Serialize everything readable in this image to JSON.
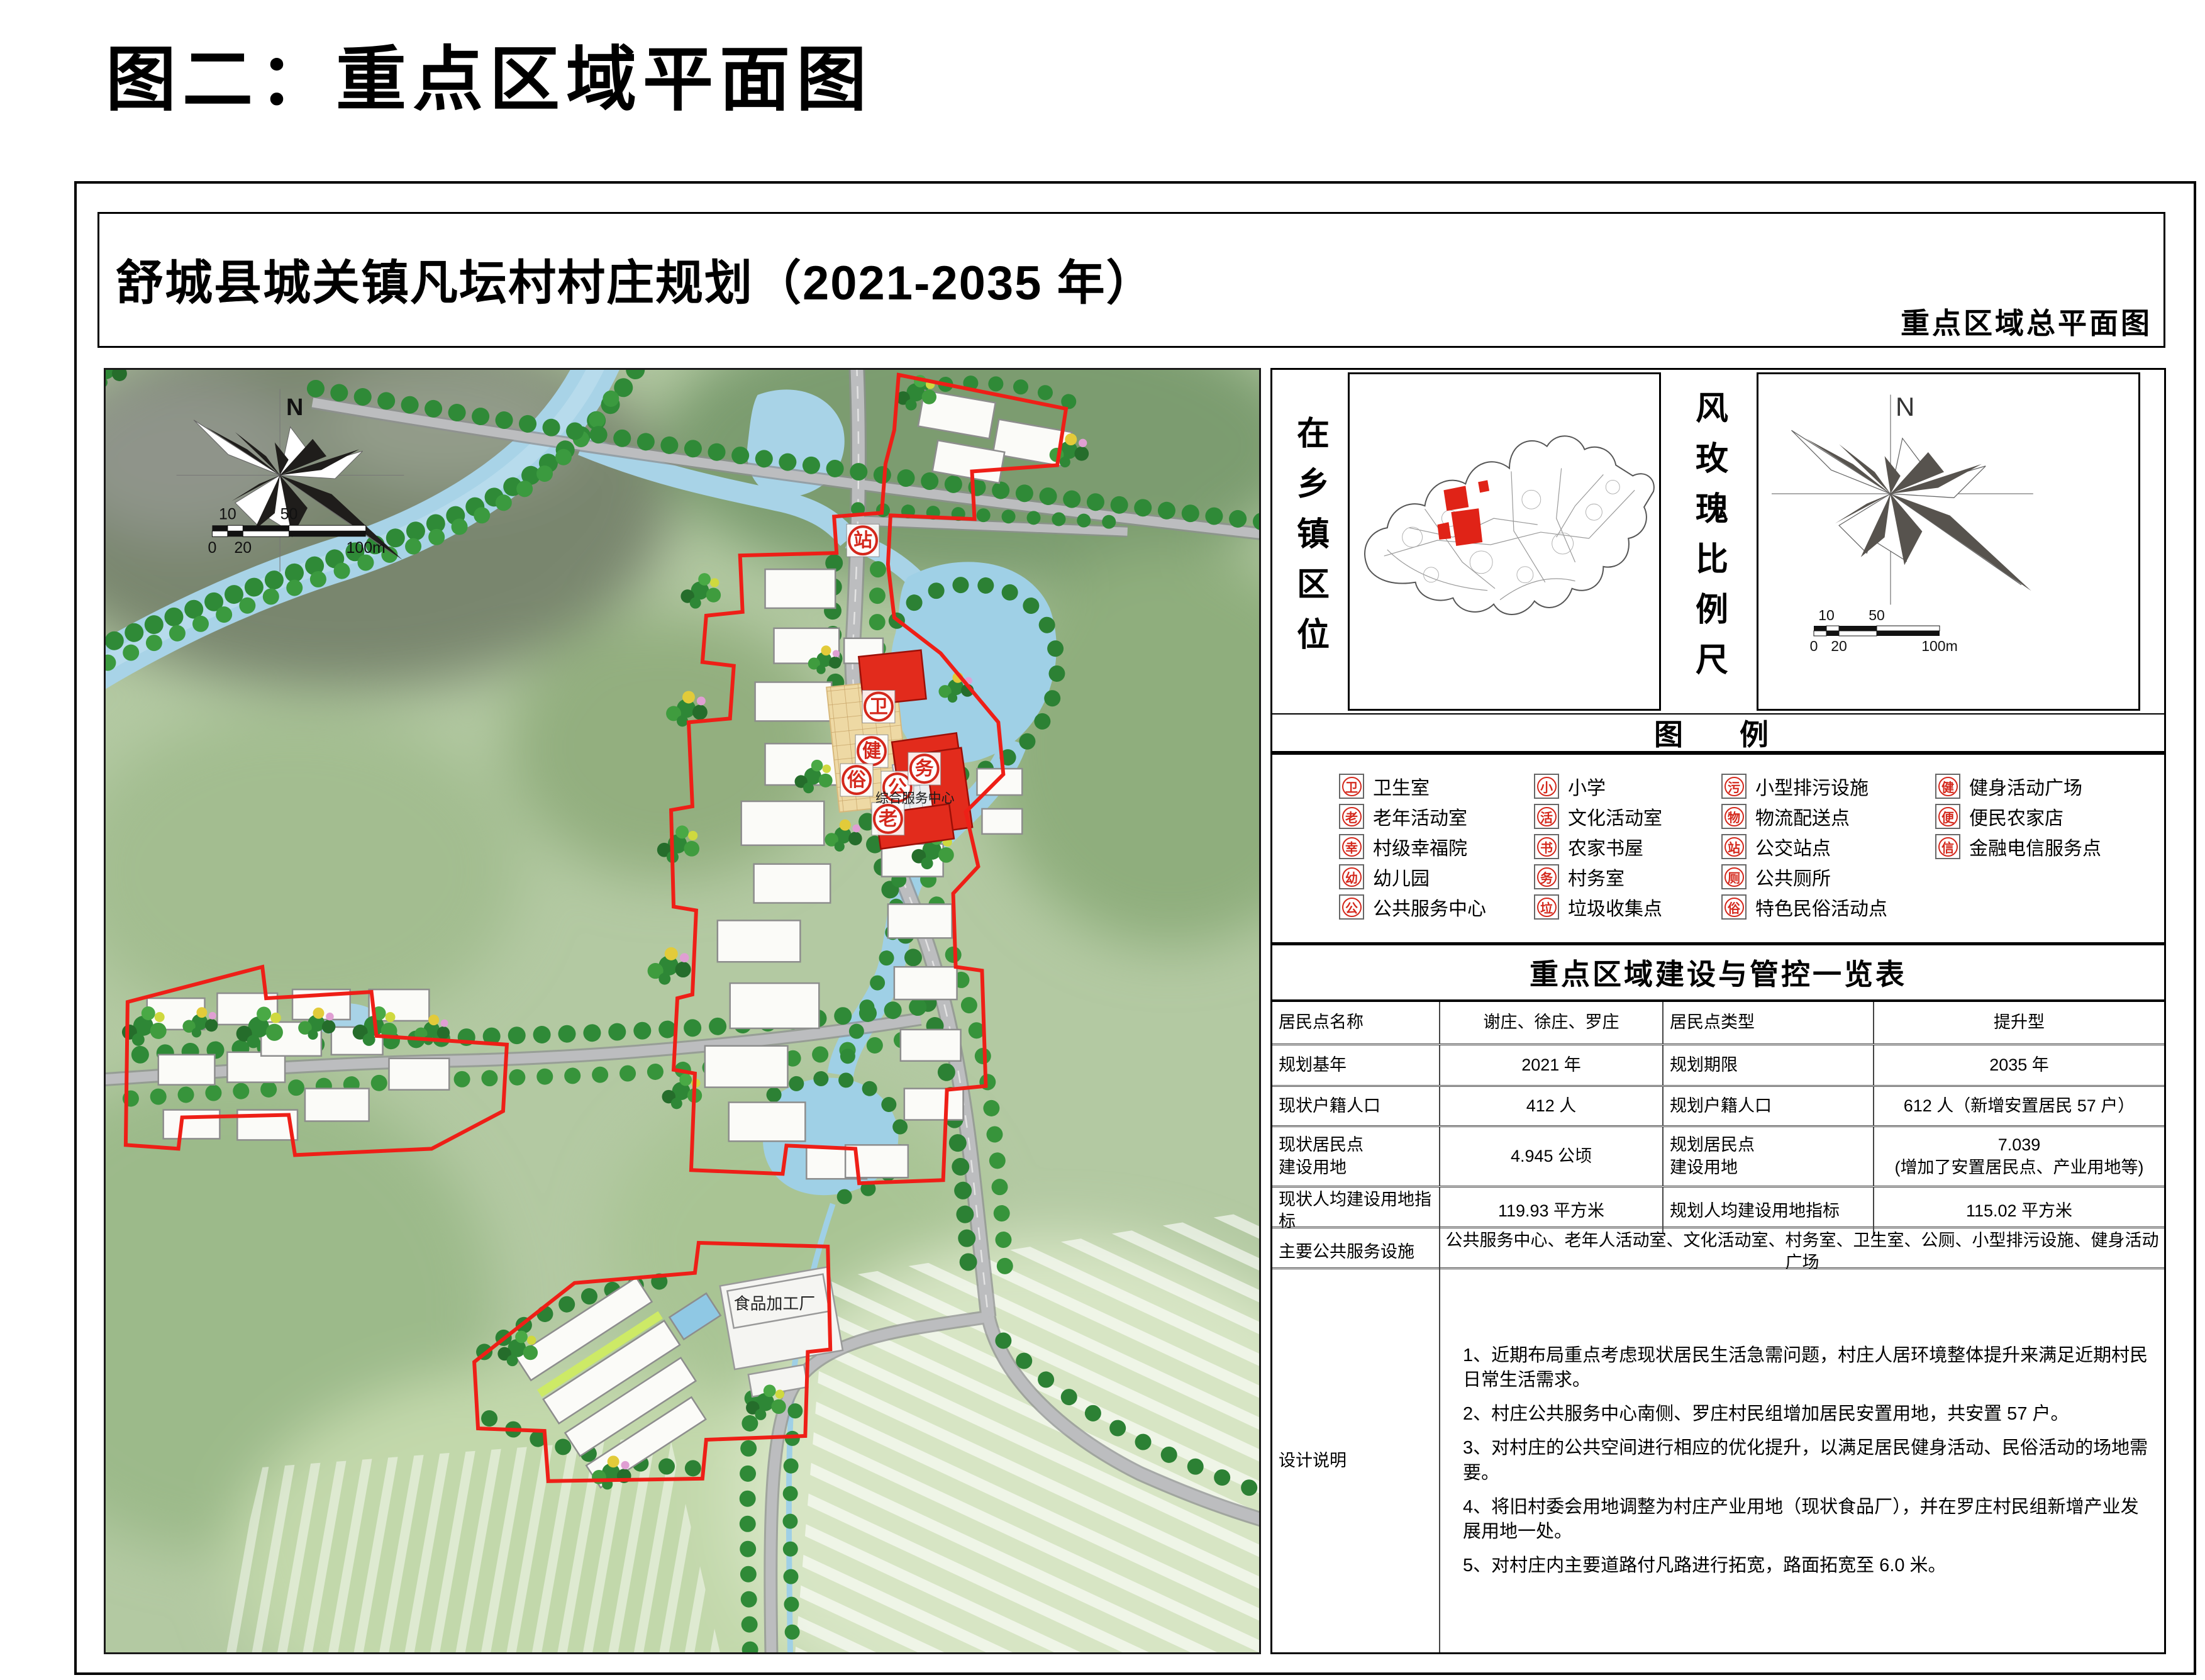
{
  "page": {
    "title": "图二：重点区域平面图"
  },
  "sheet": {
    "title": "舒城县城关镇凡坛村村庄规划（2021-2035 年）",
    "subtitle": "重点区域总平面图"
  },
  "compass": {
    "north": "N"
  },
  "scalebar": {
    "ten": "10",
    "fifty": "50",
    "zero": "0",
    "twenty": "20",
    "hundred": "100m"
  },
  "map": {
    "labels": {
      "service_center": "综合服务中心",
      "food_factory": "食品加工厂"
    },
    "poi": {
      "wei": "卫",
      "jian": "健",
      "su": "俗",
      "gong": "公",
      "wu": "务",
      "lao": "老",
      "zhan": "站"
    }
  },
  "panel": {
    "location_label": "在乡镇区位",
    "windrose_label": "风玫瑰比例尺",
    "legend": {
      "title": "图　例",
      "columns": [
        {
          "items": [
            {
              "abbr": "卫",
              "label": "卫生室"
            },
            {
              "abbr": "老",
              "label": "老年活动室"
            },
            {
              "abbr": "幸",
              "label": "村级幸福院"
            },
            {
              "abbr": "幼",
              "label": "幼儿园"
            },
            {
              "abbr": "公",
              "label": "公共服务中心"
            }
          ]
        },
        {
          "items": [
            {
              "abbr": "小",
              "label": "小学"
            },
            {
              "abbr": "活",
              "label": "文化活动室"
            },
            {
              "abbr": "书",
              "label": "农家书屋"
            },
            {
              "abbr": "务",
              "label": "村务室"
            },
            {
              "abbr": "垃",
              "label": "垃圾收集点"
            }
          ]
        },
        {
          "items": [
            {
              "abbr": "污",
              "label": "小型排污设施"
            },
            {
              "abbr": "物",
              "label": "物流配送点"
            },
            {
              "abbr": "站",
              "label": "公交站点"
            },
            {
              "abbr": "厕",
              "label": "公共厕所"
            },
            {
              "abbr": "俗",
              "label": "特色民俗活动点"
            }
          ]
        },
        {
          "items": [
            {
              "abbr": "健",
              "label": "健身活动广场"
            },
            {
              "abbr": "便",
              "label": "便民农家店"
            },
            {
              "abbr": "信",
              "label": "金融电信服务点"
            }
          ]
        }
      ]
    },
    "table": {
      "title": "重点区域建设与管控一览表",
      "rows": [
        [
          "居民点名称",
          "谢庄、徐庄、罗庄",
          "居民点类型",
          "提升型"
        ],
        [
          "规划基年",
          "2021 年",
          "规划期限",
          "2035 年"
        ],
        [
          "现状户籍人口",
          "412 人",
          "规划户籍人口",
          "612 人（新增安置居民 57 户）"
        ],
        [
          "现状居民点\n建设用地",
          "4.945 公顷",
          "规划居民点\n建设用地",
          "7.039\n(增加了安置居民点、产业用地等)"
        ],
        [
          "现状人均建设用地指标",
          "119.93 平方米",
          "规划人均建设用地指标",
          "115.02 平方米"
        ],
        [
          "主要公共服务设施",
          "公共服务中心、老年人活动室、文化活动室、村务室、卫生室、公厕、小型排污设施、健身活动广场"
        ]
      ]
    },
    "notes": {
      "label": "设计说明",
      "items": [
        "1、近期布局重点考虑现状居民生活急需问题，村庄人居环境整体提升来满足近期村民日常生活需求。",
        "2、村庄公共服务中心南侧、罗庄村民组增加居民安置用地，共安置 57 户。",
        "3、对村庄的公共空间进行相应的优化提升，以满足居民健身活动、民俗活动的场地需要。",
        "4、将旧村委会用地调整为村庄产业用地（现状食品厂），并在罗庄村民组新增产业发展用地一处。",
        "5、对村庄内主要道路付凡路进行拓宽，路面拓宽至 6.0 米。"
      ]
    }
  },
  "colors": {
    "boundary_red": "#ee1f17",
    "icon_red": "#d4281c",
    "water_blue": "#a8d3e7",
    "rose_gray": "#57534e"
  }
}
